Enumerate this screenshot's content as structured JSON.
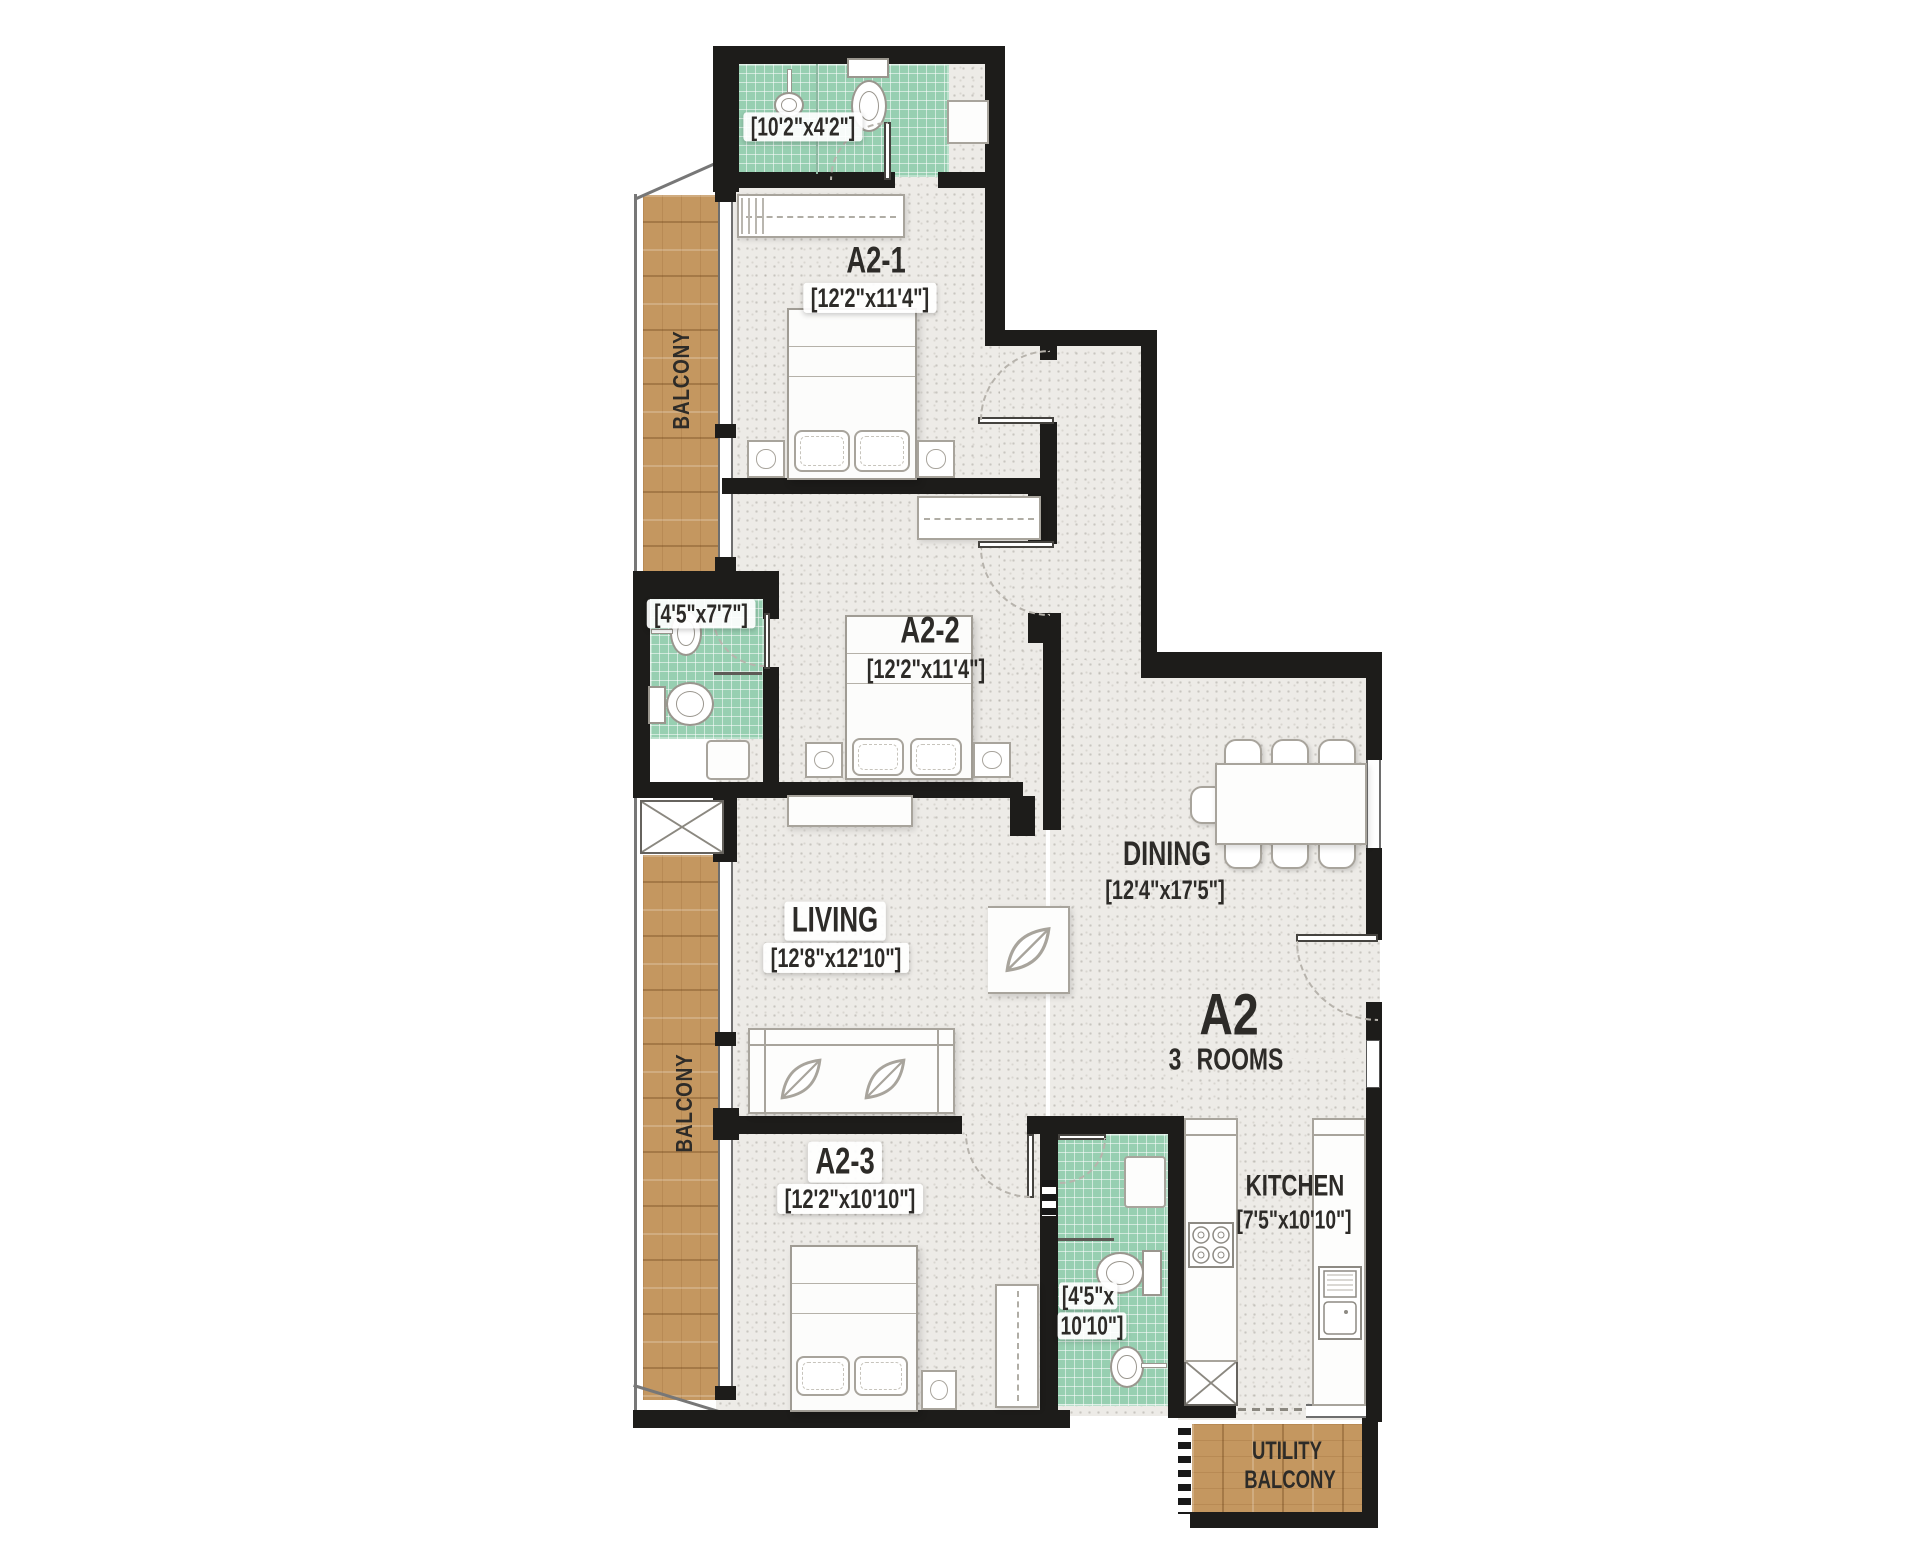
{
  "theme": {
    "wall": "#1d1c1a",
    "tile": "#97cfb1",
    "wood": "#c49760",
    "floor": "#edebe7"
  },
  "unit": {
    "name": "A2",
    "rooms_note": "3 ROOMS"
  },
  "rooms": {
    "bath_top": {
      "dims": "[10'2\"x4'2\"]"
    },
    "bedroom_1": {
      "label": "A2-1",
      "dims": "[12'2\"x11'4\"]"
    },
    "bedroom_2": {
      "label": "A2-2",
      "dims": "[12'2\"x11'4\"]"
    },
    "bath_mid": {
      "dims": "[4'5\"x7'7\"]"
    },
    "living": {
      "label": "LIVING",
      "dims": "[12'8\"x12'10\"]"
    },
    "dining": {
      "label": "DINING",
      "dims": "[12'4\"x17'5\"]"
    },
    "bedroom_3": {
      "label": "A2-3",
      "dims": "[12'2\"x10'10\"]"
    },
    "bath_bottom": {
      "dims_line1": "[4'5\"x",
      "dims_line2": "10'10\"]"
    },
    "kitchen": {
      "label": "KITCHEN",
      "dims": "[7'5\"x10'10\"]"
    },
    "balcony_top": {
      "label": "BALCONY"
    },
    "balcony_mid": {
      "label": "BALCONY"
    },
    "utility_balcony": {
      "label_line1": "UTILITY",
      "label_line2": "BALCONY"
    }
  }
}
